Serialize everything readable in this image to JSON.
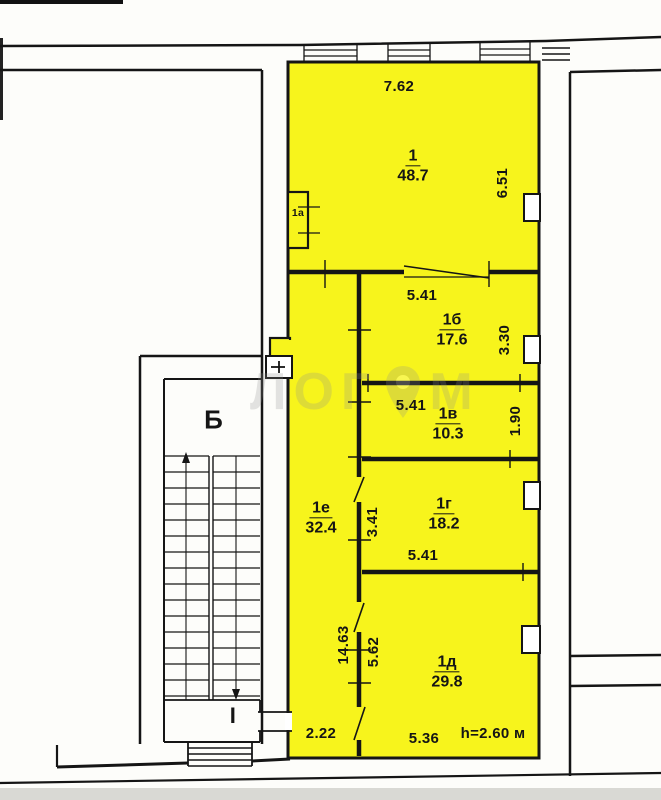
{
  "plan_title": "apartment-floor-plan-scan",
  "rooms": {
    "r1": {
      "num": "1",
      "area": "48.7"
    },
    "r1a": {
      "num": "1а"
    },
    "r1b": {
      "num": "1б",
      "area": "17.6"
    },
    "r1v": {
      "num": "1в",
      "area": "10.3"
    },
    "r1g": {
      "num": "1г",
      "area": "18.2"
    },
    "r1d": {
      "num": "1д",
      "area": "29.8"
    },
    "r1e": {
      "num": "1е",
      "area": "32.4"
    }
  },
  "dims": {
    "top_width": "7.62",
    "room1_depth": "6.51",
    "room1b_width": "5.41",
    "room1b_depth": "3.30",
    "room1v_width": "5.41",
    "room1v_depth": "1.90",
    "room1g_depth": "3.41",
    "room1g_width": "5.41",
    "corridor_length": "14.63",
    "room1d_depth": "5.62",
    "entry_width": "2.22",
    "room1d_width": "5.36",
    "ceiling_height": "h=2.60 м"
  },
  "stair": {
    "stairwell_label": "Б",
    "landing_label": "I"
  },
  "watermark": {
    "text_left": "ЛОГ",
    "text_right": "М",
    "icon": "map-pin"
  },
  "colors": {
    "room_fill": "#F7F41C",
    "wall_line": "#151515",
    "scan_background": "#fdfdfa",
    "scan_band": "#d9d9d4",
    "watermark_gray": "#8f8f8f"
  }
}
